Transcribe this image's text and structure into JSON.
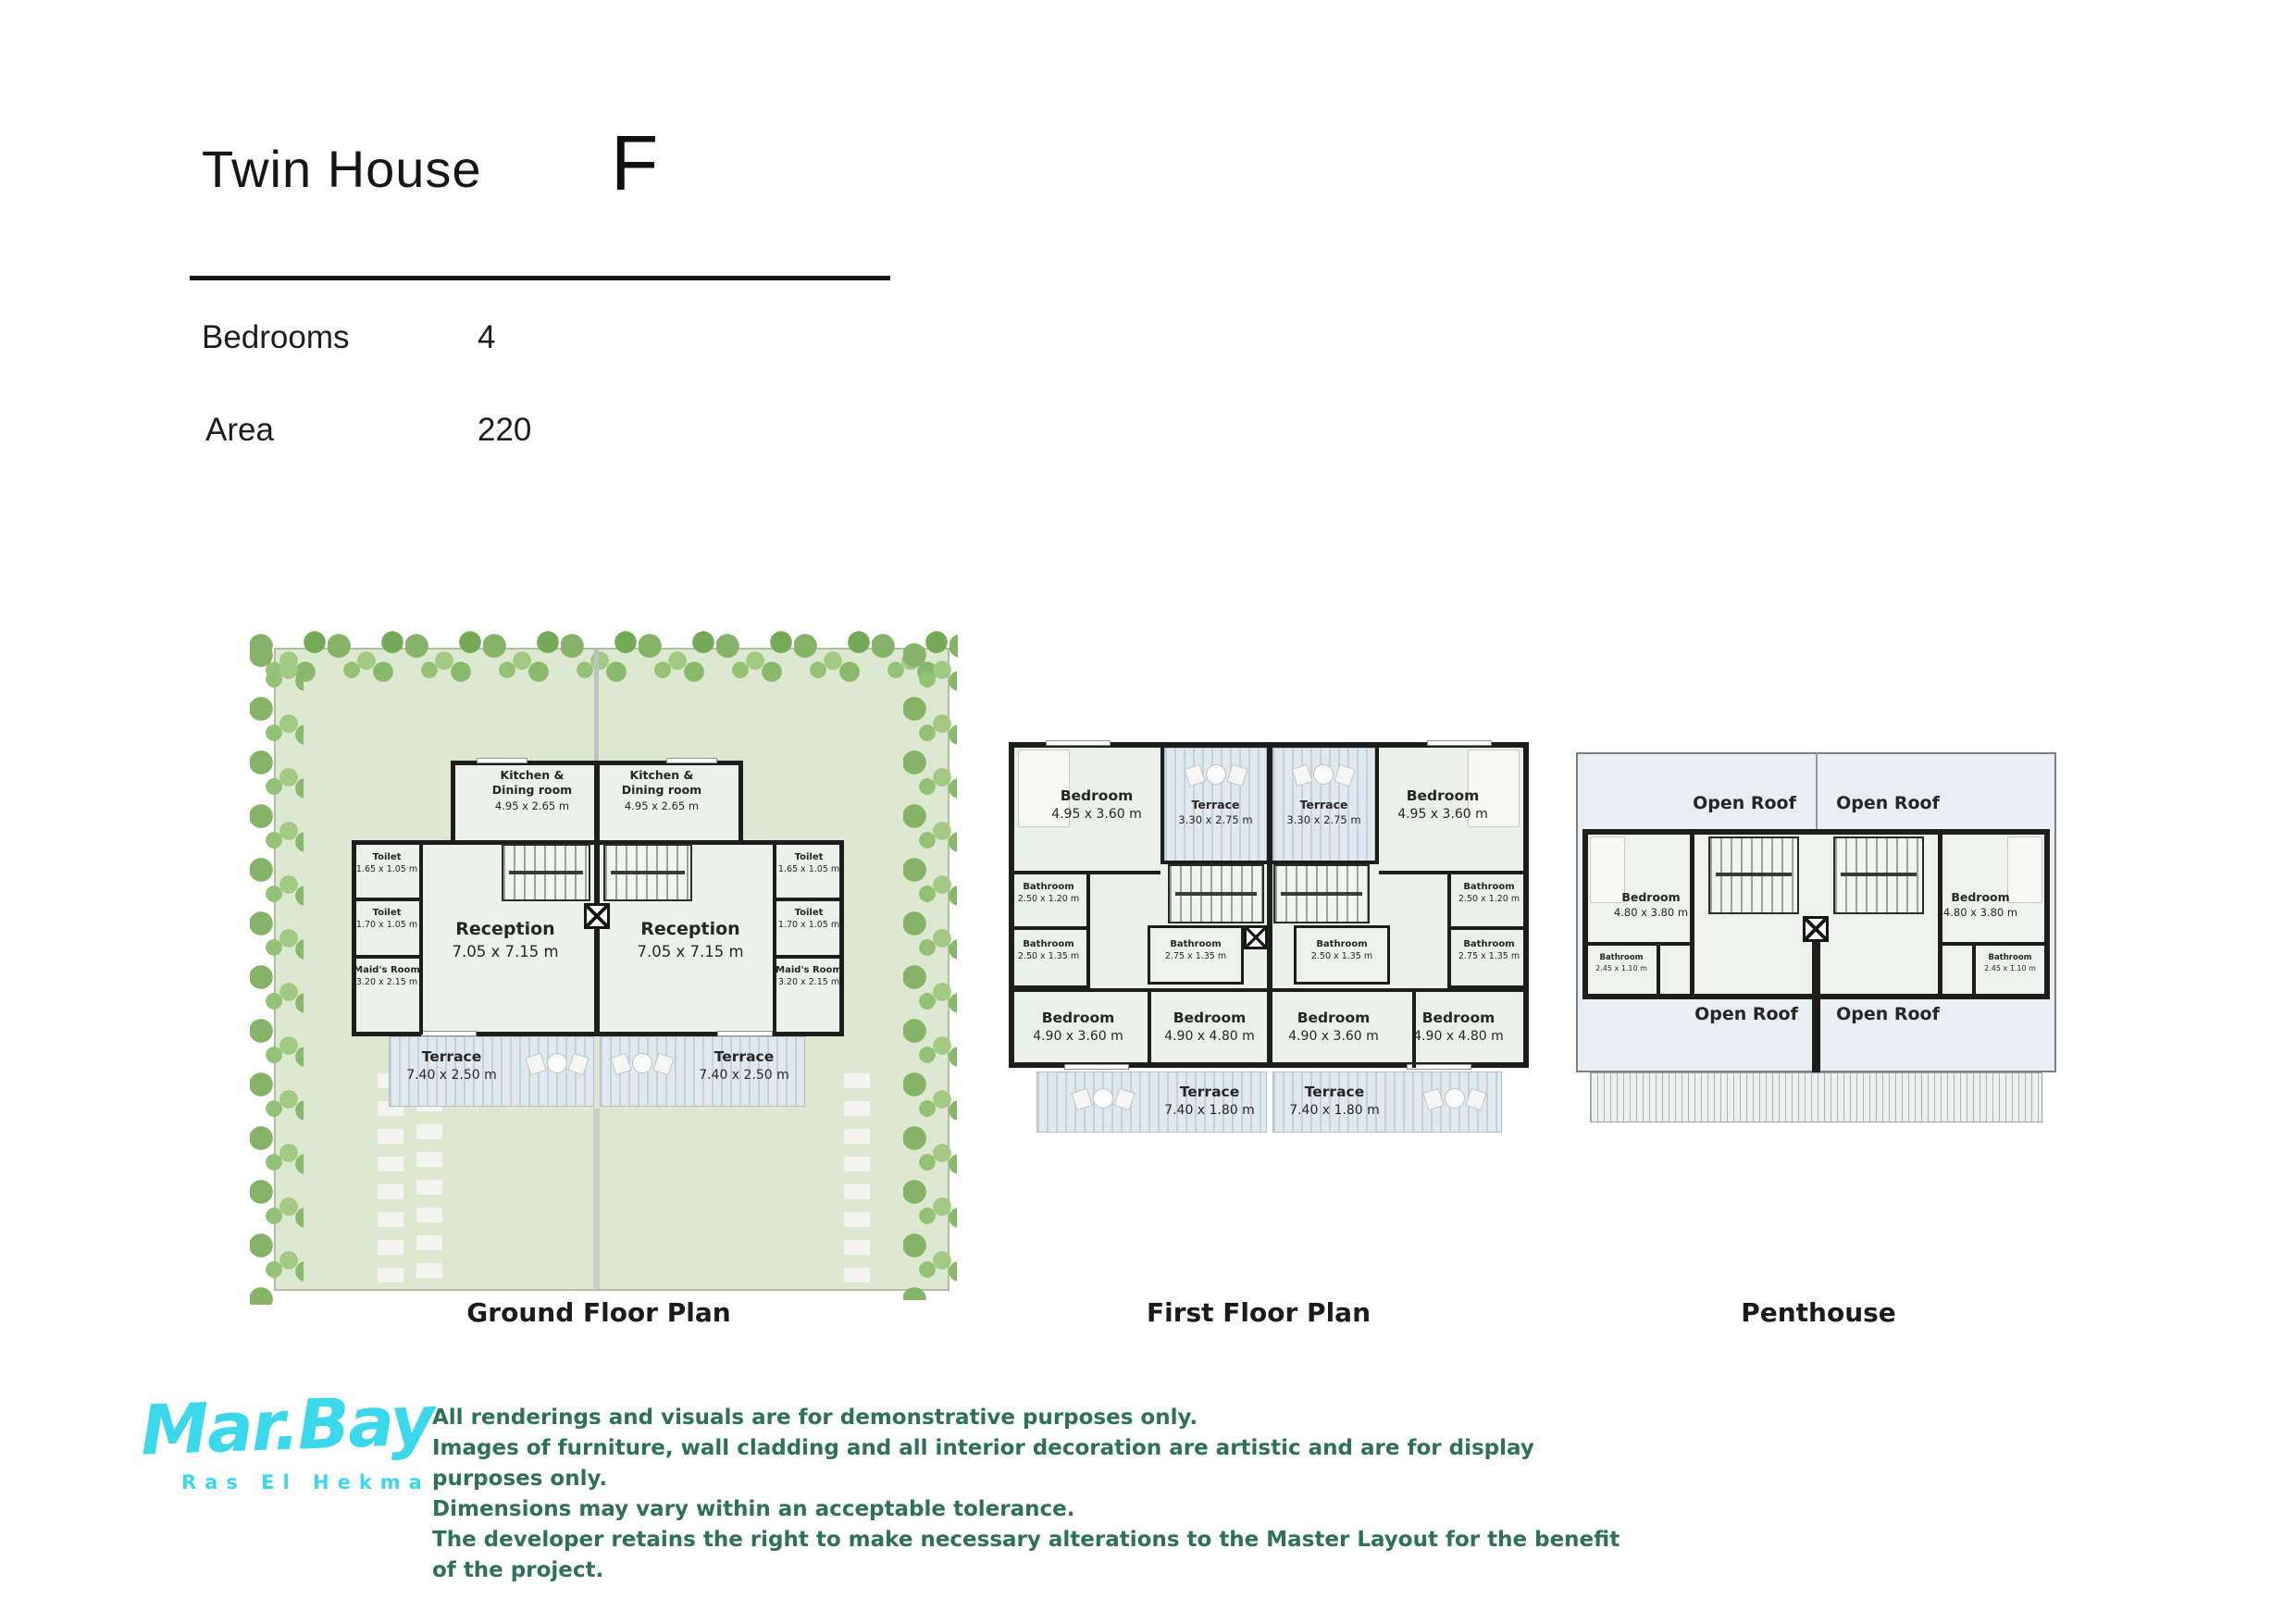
{
  "header": {
    "title": "Twin House",
    "unit_letter": "F",
    "specs": [
      {
        "label": "Bedrooms",
        "value": "4"
      },
      {
        "label": "Area",
        "value": "220"
      }
    ]
  },
  "plans": {
    "ground": {
      "caption": "Ground Floor Plan",
      "rooms": {
        "kitchen_left": {
          "name": "Kitchen &\nDining room",
          "dims": "4.95 x 2.65 m"
        },
        "kitchen_right": {
          "name": "Kitchen &\nDining room",
          "dims": "4.95 x 2.65 m"
        },
        "toilet_upper_left": {
          "name": "Toilet",
          "dims": "1.65 x 1.05 m"
        },
        "toilet_lower_left": {
          "name": "Toilet",
          "dims": "1.70 x 1.05 m"
        },
        "maids_room_left": {
          "name": "Maid's Room",
          "dims": "3.20 x 2.15 m"
        },
        "reception_left": {
          "name": "Reception",
          "dims": "7.05 x 7.15 m"
        },
        "toilet_upper_right": {
          "name": "Toilet",
          "dims": "1.65 x 1.05 m"
        },
        "toilet_lower_right": {
          "name": "Toilet",
          "dims": "1.70 x 1.05 m"
        },
        "maids_room_right": {
          "name": "Maid's Room",
          "dims": "3.20 x 2.15 m"
        },
        "reception_right": {
          "name": "Reception",
          "dims": "7.05 x 7.15 m"
        },
        "terrace_left": {
          "name": "Terrace",
          "dims": "7.40 x 2.50 m"
        },
        "terrace_right": {
          "name": "Terrace",
          "dims": "7.40 x 2.50 m"
        }
      }
    },
    "first": {
      "caption": "First Floor Plan",
      "rooms": {
        "bedroom_top_left": {
          "name": "Bedroom",
          "dims": "4.95 x 3.60 m"
        },
        "terrace_top_left": {
          "name": "Terrace",
          "dims": "3.30 x 2.75 m"
        },
        "terrace_top_right": {
          "name": "Terrace",
          "dims": "3.30 x 2.75 m"
        },
        "bedroom_top_right": {
          "name": "Bedroom",
          "dims": "4.95 x 3.60 m"
        },
        "bathroom_upper_left": {
          "name": "Bathroom",
          "dims": "2.50 x 1.20 m"
        },
        "bathroom_lower_left": {
          "name": "Bathroom",
          "dims": "2.50 x 1.35 m"
        },
        "bathroom_center_left": {
          "name": "Bathroom",
          "dims": "2.75 x 1.35 m"
        },
        "bathroom_center_right": {
          "name": "Bathroom",
          "dims": "2.50 x 1.35 m"
        },
        "bathroom_upper_right": {
          "name": "Bathroom",
          "dims": "2.50 x 1.20 m"
        },
        "bathroom_lower_right": {
          "name": "Bathroom",
          "dims": "2.75 x 1.35 m"
        },
        "bedroom_bottom_far_left": {
          "name": "Bedroom",
          "dims": "4.90 x 3.60 m"
        },
        "bedroom_bottom_center_left": {
          "name": "Bedroom",
          "dims": "4.90 x 4.80 m"
        },
        "bedroom_bottom_center_right": {
          "name": "Bedroom",
          "dims": "4.90 x 3.60 m"
        },
        "bedroom_bottom_far_right": {
          "name": "Bedroom",
          "dims": "4.90 x 4.80 m"
        },
        "terrace_bottom_left": {
          "name": "Terrace",
          "dims": "7.40 x 1.80 m"
        },
        "terrace_bottom_right": {
          "name": "Terrace",
          "dims": "7.40 x 1.80 m"
        }
      }
    },
    "penthouse": {
      "caption": "Penthouse",
      "rooms": {
        "open_roof_top_left": {
          "name": "Open Roof"
        },
        "open_roof_top_right": {
          "name": "Open Roof"
        },
        "open_roof_bottom_left": {
          "name": "Open Roof"
        },
        "open_roof_bottom_right": {
          "name": "Open Roof"
        },
        "bedroom_left": {
          "name": "Bedroom",
          "dims": "4.80 x 3.80 m"
        },
        "bedroom_right": {
          "name": "Bedroom",
          "dims": "4.80 x 3.80 m"
        },
        "bathroom_left": {
          "name": "Bathroom",
          "dims": "2.45 x 1.10 m"
        },
        "bathroom_right": {
          "name": "Bathroom",
          "dims": "2.45 x 1.10 m"
        }
      }
    }
  },
  "footer": {
    "brand": {
      "name": "Mar.Bay",
      "tagline": "Ras El Hekma"
    },
    "disclaimer": [
      "All renderings and visuals are for demonstrative purposes only.",
      "Images of furniture, wall cladding and all interior decoration are artistic and are for display purposes only.",
      "Dimensions may vary within an acceptable tolerance.",
      "The developer retains the right to make necessary alterations to the Master Layout for the benefit of the project."
    ]
  },
  "colors": {
    "brand_cyan": "#3bd7ea",
    "disclaimer_green": "#2d7158",
    "wall_black": "#1d1d1b",
    "lawn_green": "#dce8d0",
    "terrace_blue": "#dfe9ee"
  }
}
